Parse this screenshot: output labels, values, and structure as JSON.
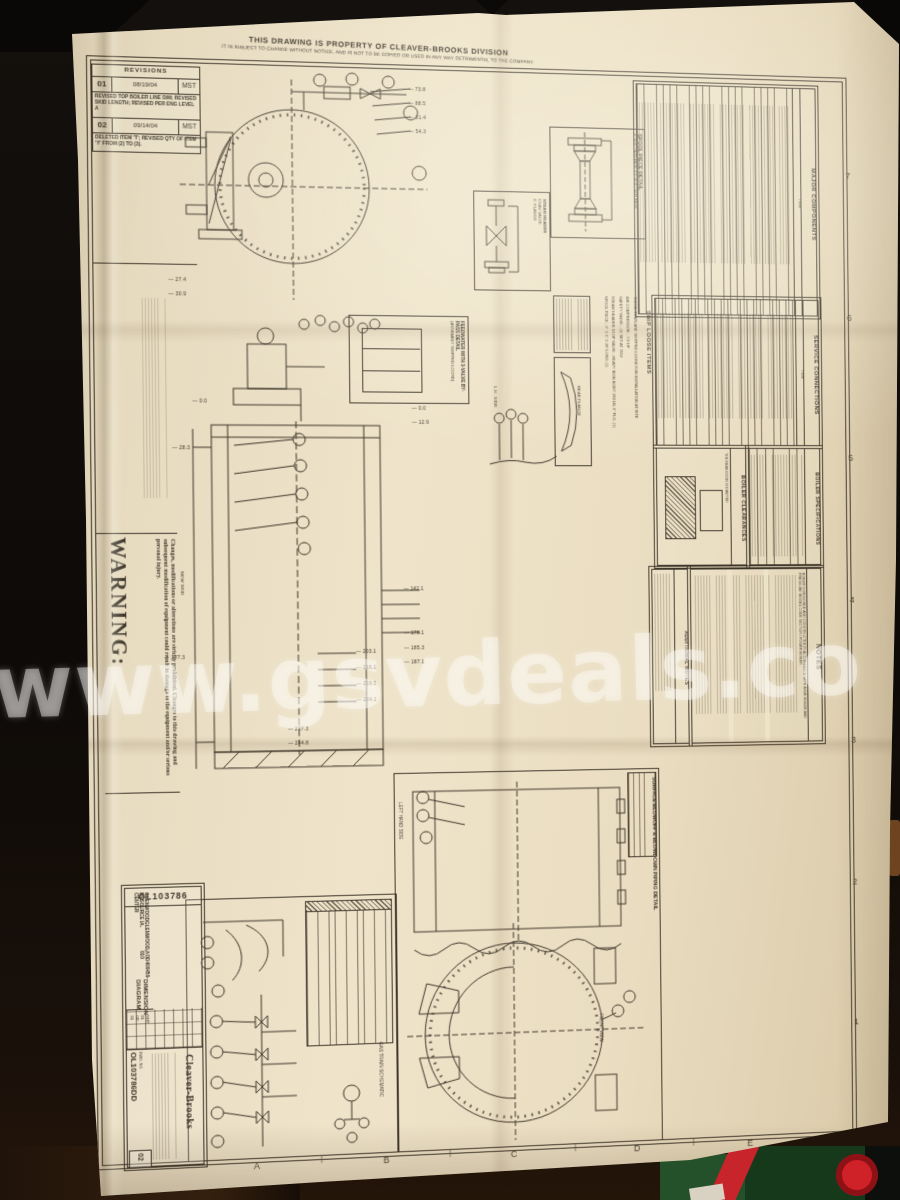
{
  "photo": {
    "watermark_text": "www.gsvdeals.co"
  },
  "sheet": {
    "property_notice": {
      "line1": "THIS DRAWING IS PROPERTY OF CLEAVER-BROOKS DIVISION",
      "line2": "IT IS SUBJECT TO CHANGE WITHOUT NOTICE, AND IS NOT TO BE COPIED OR USED IN ANY WAY DETRIMENTAL TO THE COMPANY."
    },
    "revisions": {
      "header": "REVISIONS",
      "rows": [
        {
          "no": "01",
          "date": "08/19/04",
          "by": "MST",
          "note": "REVISED TOP BOILER LINE DIM; REVISED SKID LENGTH; REVISED PER ENG LEVEL A"
        },
        {
          "no": "02",
          "date": "09/14/04",
          "by": "MST",
          "note": "DELETED ITEM 'T'; REVISED QTY OF ITEM 'Y' FROM (2) TO (3)."
        }
      ]
    },
    "warning": {
      "title": "WARNING:",
      "body": "Changes, modifications or alterations are strictly prohibited. Changes to this drawing and subsequent modification of equipment could result in damage to the equipment and/or serious personal injury."
    },
    "title_block": {
      "drawing_no": "OL103786",
      "line1": "GLENWOOD RESOURCE CENTER",
      "line2": "GLENWOOD, IA.",
      "line3": "AOD400456-010",
      "title": "DIMENSION DIAGRAM",
      "sheet": "SHT 01 OF 01",
      "company": "Cleaver-Brooks",
      "dwg_label": "DWG. NO.",
      "dwg_no": "OL103786DD",
      "rev": "02"
    },
    "grid": {
      "bottom_letters": [
        "A",
        "B",
        "C",
        "D",
        "E"
      ],
      "right_numbers": [
        "7",
        "6",
        "5",
        "4",
        "3",
        "2",
        "1"
      ]
    },
    "tables": {
      "major_components": {
        "title": "MAJOR COMPONENTS",
        "item_col": "ITEM"
      },
      "service_connections": {
        "title": "SERVICE CONNECTIONS",
        "item_col": "ITEM"
      },
      "boiler_specifications": {
        "title": "BOILER SPECIFICATIONS"
      },
      "boiler_clearances": {
        "title": "BOILER CLEARANCES",
        "note": "THE REAR DOOR IS DAVITED"
      },
      "ship_loose_items": {
        "title": "SHIP LOOSE ITEMS",
        "lines": [
          "THESE ITEMS ARE SHIPPED LOOSE FOR INSTALLATION AT SITE",
          "AIR COMPRESSOR - 7.5 HP",
          "SAFETY VALVE - (2) SET AT 150#",
          "STEAM HEADER STOP VALVE - HEAVY IRON BODY 250 LB. 6\" FLG. (1)",
          "SPOOL PIECE - 6\" X 6\" X 48\" LONG (1)"
        ]
      },
      "notes": {
        "title": "NOTES",
        "first_line": "BOILER IS DESIGNED AND CONSTRUCTED IN ACCORDANCE WITH ASME BOILER AND PRESSURE VESSEL CODE SECTION I POWER BOILER"
      },
      "additional_notes": {
        "title": "ADDITIONAL NOTES"
      }
    },
    "details": {
      "spool_piece": {
        "title": "SPOOL PIECE DETAIL",
        "subtitle": "6\" SLIP ON FLANGE X 6\" SLIP ON FLANGE"
      },
      "steam_header": {
        "line1": "STEAM HEADER",
        "line2": "CSAV VALVE",
        "line3": "6\" FLANGE"
      },
      "feedwater": {
        "label": "FEEDWATER WITH 3-VALVE BY-PASS DETAIL",
        "sub": "(ASSEMBLY SHIPPED LOOSE)"
      },
      "surface_blowoff": {
        "title": "SURFACE BLOWOFF & BLOWDOWN PIPING DETAIL",
        "left_label": "LEFT HAND SIDE",
        "front_label": "FRONT VIEW"
      },
      "gas_train": {
        "label": "GAS TRAIN SCHEMATIC"
      }
    },
    "labels": {
      "lh_side": "L.H. SIDE",
      "rear_flange": "REAR FLANGE",
      "new_skid": "NEW SKID"
    },
    "dimensions": {
      "front_view": [
        "73.8",
        "88.5",
        "81.4",
        "54.3"
      ],
      "left_flange": [
        "27.4",
        "30.9"
      ],
      "upper": [
        "0.0",
        "0.0",
        "12.9",
        "28.3"
      ],
      "side_right": [
        "142.1",
        "178.1",
        "185.3",
        "187.1"
      ],
      "side_mid": [
        "203.1",
        "216.1",
        "219.1",
        "224.1"
      ],
      "side_lower": [
        "237.3",
        "244.8"
      ],
      "skid": "177.3"
    }
  }
}
